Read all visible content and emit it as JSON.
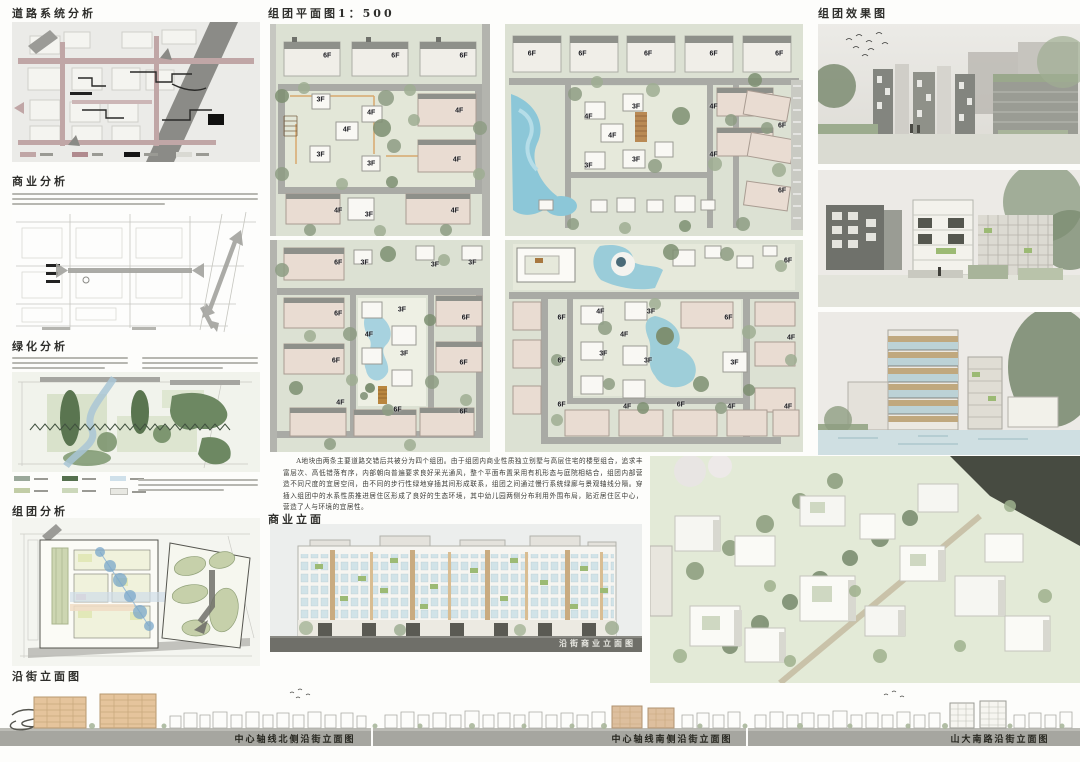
{
  "page": {
    "background": "#fdfdfb"
  },
  "titles": {
    "road": "道路系统分析",
    "commerce": "商业分析",
    "greening": "绿化分析",
    "cluster": "组团分析",
    "plan": "组团平面图1：500",
    "render": "组团效果图",
    "commercial_elevation": "商业立面",
    "street_elevation": "沿街立面图"
  },
  "description": "A地块由两条主要道路交错后共被分为四个组团。由于组团内商业性质独立别墅与高层住宅的楼型组合，追求丰富层次、高低错落有序，内部朝向普遍要求良好采光通风，整个平面布置采用有机形态与庭院相结合，组团内部营造不同尺度的宜居空间，由不同的步行性绿地穿插其间形成联系，组团之间通过慢行系统绿廊与景观轴线分隔。穿插入组团中的水系性质推进居住区形成了良好的生态环境，其中幼儿园两侧分布利用外围布局，贴近居住区中心，营造了人与环境的宜居性。",
  "captions": {
    "commercial_elevation": "沿街商业立面图",
    "street_segments": [
      "中心轴线北侧沿街立面图",
      "中心轴线南侧沿街立面图",
      "山大南路沿街立面图"
    ]
  },
  "plans": {
    "p1_labels": [
      {
        "t": "6F",
        "x": 26,
        "y": 15
      },
      {
        "t": "6F",
        "x": 57,
        "y": 15
      },
      {
        "t": "6F",
        "x": 88,
        "y": 15
      },
      {
        "t": "3F",
        "x": 23,
        "y": 36
      },
      {
        "t": "4F",
        "x": 46,
        "y": 42
      },
      {
        "t": "4F",
        "x": 35,
        "y": 50
      },
      {
        "t": "4F",
        "x": 86,
        "y": 41
      },
      {
        "t": "3F",
        "x": 23,
        "y": 62
      },
      {
        "t": "3F",
        "x": 46,
        "y": 66
      },
      {
        "t": "4F",
        "x": 85,
        "y": 64
      },
      {
        "t": "4F",
        "x": 31,
        "y": 88
      },
      {
        "t": "3F",
        "x": 45,
        "y": 90
      },
      {
        "t": "4F",
        "x": 84,
        "y": 88
      }
    ],
    "p2_labels": [
      {
        "t": "6F",
        "x": 9,
        "y": 14
      },
      {
        "t": "6F",
        "x": 26,
        "y": 14
      },
      {
        "t": "6F",
        "x": 48,
        "y": 14
      },
      {
        "t": "6F",
        "x": 70,
        "y": 14
      },
      {
        "t": "6F",
        "x": 92,
        "y": 14
      },
      {
        "t": "4F",
        "x": 28,
        "y": 44
      },
      {
        "t": "3F",
        "x": 44,
        "y": 39
      },
      {
        "t": "4F",
        "x": 36,
        "y": 53
      },
      {
        "t": "3F",
        "x": 28,
        "y": 67
      },
      {
        "t": "3F",
        "x": 44,
        "y": 64
      },
      {
        "t": "4F",
        "x": 70,
        "y": 39
      },
      {
        "t": "4F",
        "x": 70,
        "y": 62
      },
      {
        "t": "6F",
        "x": 93,
        "y": 48
      },
      {
        "t": "6F",
        "x": 93,
        "y": 79
      }
    ],
    "p3_labels": [
      {
        "t": "6F",
        "x": 31,
        "y": 11
      },
      {
        "t": "3F",
        "x": 43,
        "y": 11
      },
      {
        "t": "3F",
        "x": 75,
        "y": 12
      },
      {
        "t": "3F",
        "x": 92,
        "y": 11
      },
      {
        "t": "6F",
        "x": 31,
        "y": 35
      },
      {
        "t": "3F",
        "x": 60,
        "y": 33
      },
      {
        "t": "4F",
        "x": 45,
        "y": 45
      },
      {
        "t": "6F",
        "x": 89,
        "y": 37
      },
      {
        "t": "6F",
        "x": 30,
        "y": 57
      },
      {
        "t": "3F",
        "x": 61,
        "y": 54
      },
      {
        "t": "6F",
        "x": 88,
        "y": 58
      },
      {
        "t": "4F",
        "x": 32,
        "y": 77
      },
      {
        "t": "6F",
        "x": 58,
        "y": 80
      },
      {
        "t": "6F",
        "x": 88,
        "y": 81
      }
    ],
    "p4_labels": [
      {
        "t": "6F",
        "x": 95,
        "y": 10
      },
      {
        "t": "6F",
        "x": 19,
        "y": 37
      },
      {
        "t": "4F",
        "x": 32,
        "y": 34
      },
      {
        "t": "3F",
        "x": 49,
        "y": 34
      },
      {
        "t": "6F",
        "x": 75,
        "y": 37
      },
      {
        "t": "4F",
        "x": 96,
        "y": 46
      },
      {
        "t": "4F",
        "x": 40,
        "y": 45
      },
      {
        "t": "6F",
        "x": 19,
        "y": 57
      },
      {
        "t": "3F",
        "x": 33,
        "y": 54
      },
      {
        "t": "3F",
        "x": 48,
        "y": 57
      },
      {
        "t": "3F",
        "x": 77,
        "y": 58
      },
      {
        "t": "6F",
        "x": 19,
        "y": 78
      },
      {
        "t": "4F",
        "x": 41,
        "y": 79
      },
      {
        "t": "6F",
        "x": 59,
        "y": 78
      },
      {
        "t": "4F",
        "x": 76,
        "y": 79
      },
      {
        "t": "4F",
        "x": 95,
        "y": 79
      }
    ]
  },
  "colors": {
    "plan_background": "#dce1d3",
    "road_gray": "#a9aaa5",
    "water_blue": "#8cc7d8",
    "tree_green": "#9fae93",
    "building_pink": "#e9dcd2",
    "analysis_road_pink": "#c0a6a6",
    "green_dark": "#55704e",
    "green_light": "#ccd8ba",
    "ground_band": "#a6a6a0",
    "elevation_glass": "#cfe2e7",
    "elevation_green": "#9cba74"
  }
}
